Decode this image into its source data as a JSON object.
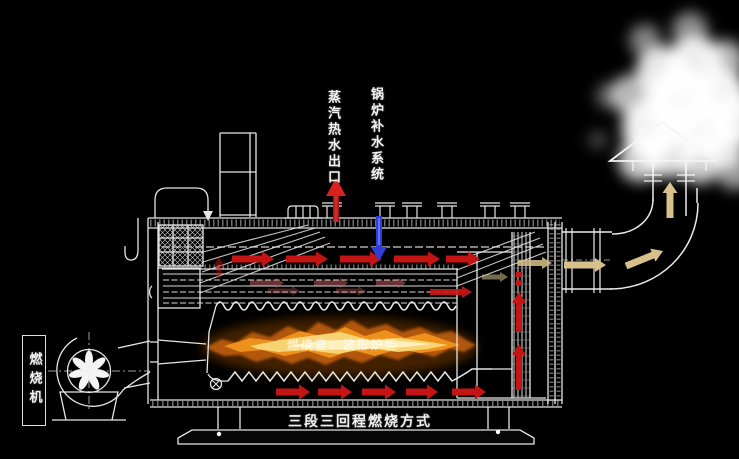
{
  "diagram": {
    "labels": {
      "steam_hot_water_outlet": "蒸汽热水出口",
      "boiler_feedwater_system": "锅炉补水系统",
      "burner": "燃烧机",
      "combustion_mode": "三段三回程燃烧方式",
      "furnace_note": "燃烧室：波形炉胆"
    },
    "colors": {
      "background": "#000000",
      "line_art": "#e8e8e8",
      "hot_gas_arrow": "#c41414",
      "steam_outlet_arrow": "#c01313",
      "feedwater_arrow": "#2e3fd6",
      "flue_exhaust_arrow": "#d8c08a",
      "flame_outer": "#b85a08",
      "flame_mid": "#f0941e",
      "flame_core": "#fdf3c8",
      "steam_cloud": "#ffffff"
    }
  }
}
